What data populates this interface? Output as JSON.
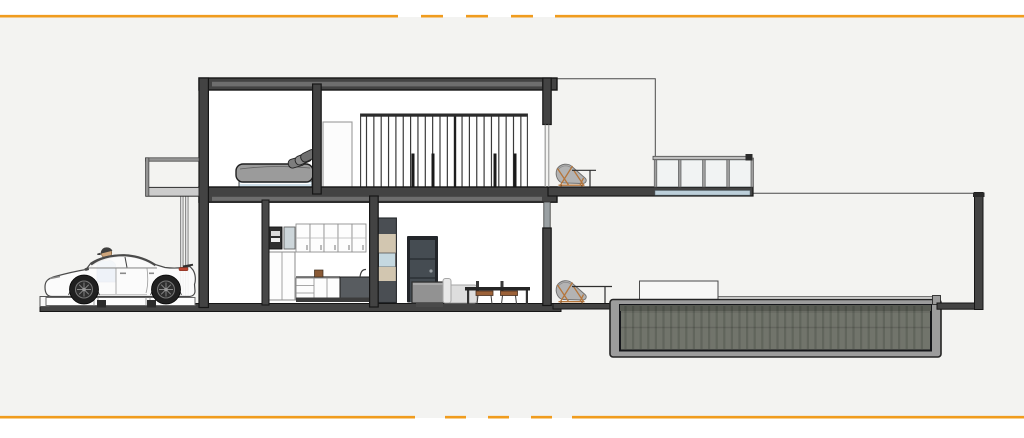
{
  "page": {
    "kind": "architectural-section-rendering",
    "visible_text": "none",
    "description": "Cut-away side section of a two-storey modern house: carport with white sports car and standing person at left, bedroom with bed and slatted wardrobe wall upstairs, kitchen and dining room on the ground floor, roof terrace with glass railing and lounge chair, garden courtyard with sunken pool at right. Framed by orange partially-dashed rule lines top and bottom."
  },
  "colors": {
    "canvas_bg": "#f3f3f1",
    "accent_orange": "#f09c1e",
    "structure_dark": "#434343",
    "structure_outline": "#161616",
    "slab_recess": "#6e6e6e",
    "interior_white": "#ffffff",
    "glass_blue": "#bccfda",
    "window_blue": "#c5d8e0",
    "bed_mattress": "#9b9b9b",
    "bed_base": "#cfe0ea",
    "pool_shell": "#9c9c9c",
    "pool_water": "#71746b",
    "pool_waterline": "#585b53",
    "wood_tan": "#d2c6b0",
    "door_slate": "#454c52",
    "door_frame": "#23262a",
    "chair_frame": "#b5763c",
    "chair_cushion": "#b3b3b3",
    "car_body": "#fcfcfc",
    "car_glass": "#e1e8eb",
    "shirt_blue": "#4e80c4",
    "skin": "#cfa67c",
    "taillight_red": "#b8432f",
    "counter_dark": "#585c60",
    "cabinet_white": "#fdfdfd",
    "island_gray": "#929292",
    "sofa_gray": "#dedede",
    "dining_seat_brown": "#9c6239"
  },
  "details": {
    "wardrobe_slat_count": 22,
    "wardrobe_pull_positions": [
      411.5,
      431.5,
      493.5,
      513.5
    ],
    "upper_cabinet_door_count": 5,
    "terrace_railing_panel_count": 4,
    "pool_texture_line_step": 7.6,
    "balcony_support_post_count": 2,
    "outdoor_chair_count": 2
  },
  "scene": {
    "elements": [
      "orange-border-top",
      "orange-border-bottom",
      "white-sports-car",
      "person-blue-shirt",
      "car-lift-platform",
      "left-balcony",
      "bedroom-bed",
      "slatted-wardrobe-wall",
      "bedroom-door-outline",
      "kitchen-upper-cabinets",
      "built-in-coffee-machine",
      "kitchen-base-cabinets",
      "dark-counter-unit",
      "tall-wood-tower",
      "dark-interior-door",
      "gray-island-cabinet",
      "light-sofa",
      "dining-table-with-chairs",
      "terrace-glass-railing",
      "terrace-lounge-chair",
      "garden-lounge-chair",
      "sunken-pool",
      "courtyard-wall-outline",
      "right-fence-post"
    ]
  }
}
